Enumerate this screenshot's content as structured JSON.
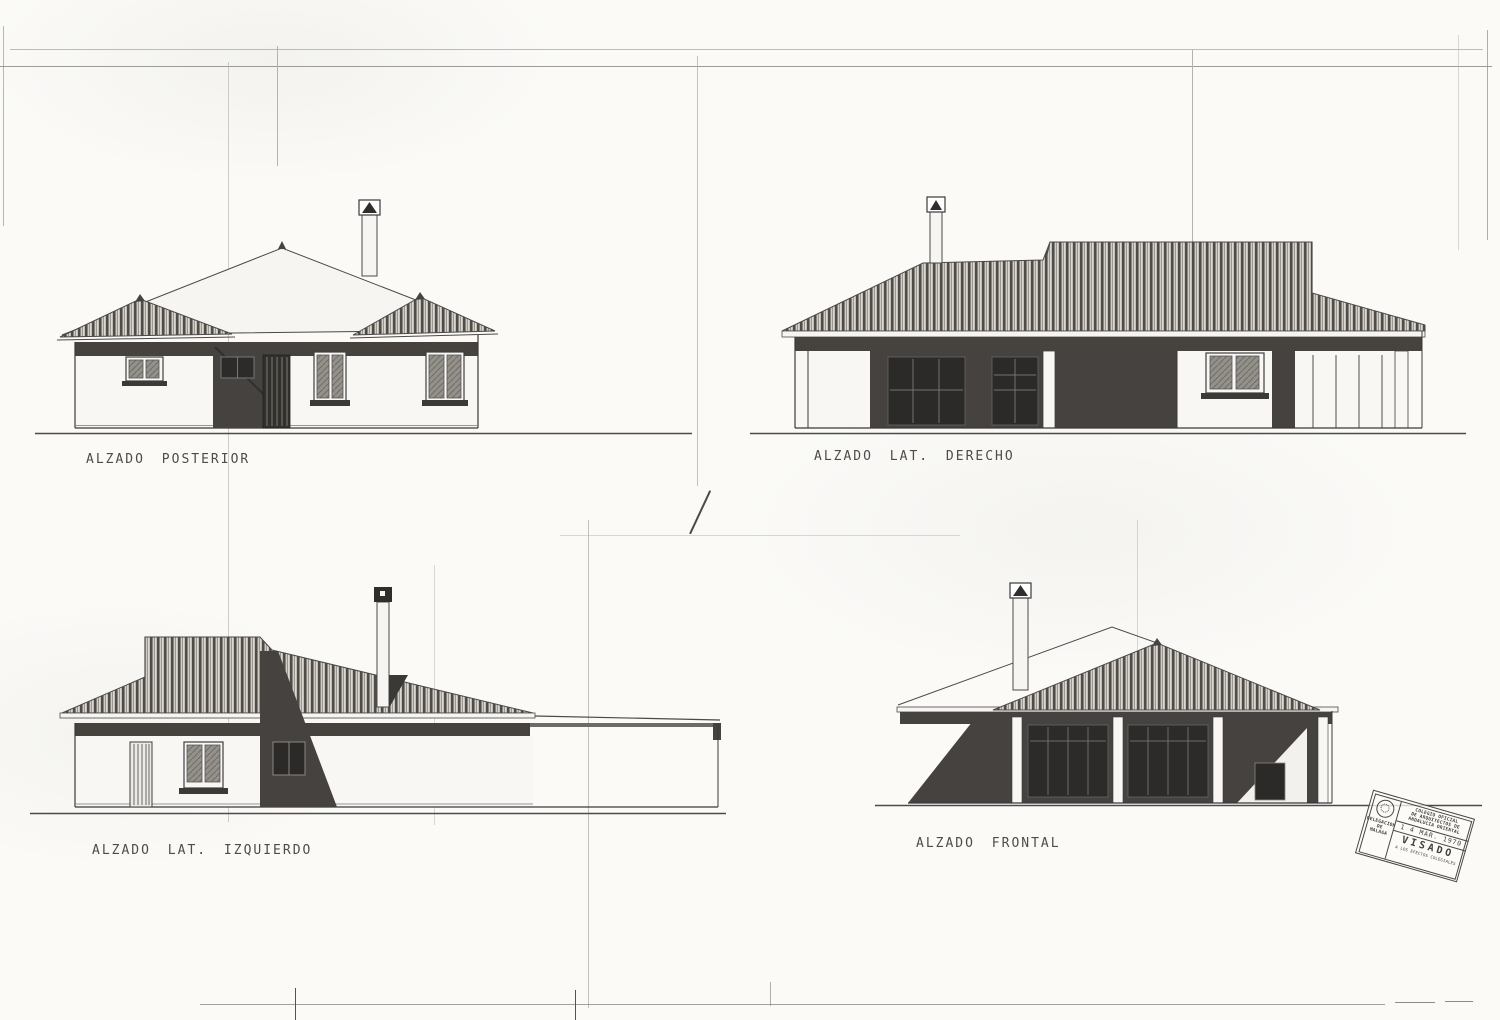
{
  "labels": {
    "posterior": "ALZADO POSTERIOR",
    "lat_derecho": "ALZADO LAT. DERECHO",
    "lat_izquierdo": "ALZADO LAT. IZQUIERDO",
    "frontal": "ALZADO FRONTAL"
  },
  "stamp": {
    "org_line1": "COLEGIO OFICIAL",
    "org_line2": "DE ARQUITECTOS DE",
    "org_line3": "ANDALUCIA ORIENTAL",
    "date": "1 4 MAR. 1970",
    "visado": "VISADO",
    "footnote": "A LOS EFECTOS COLEGIALES",
    "delegation_line1": "DELEGACION",
    "delegation_line2": "DE",
    "delegation_line3": "MALAGA"
  },
  "colors": {
    "ink": "#3a3a3a",
    "paper": "#fbfaf7",
    "dark_shadow_fill": "#454240",
    "roof_stripe": "#504d49"
  }
}
